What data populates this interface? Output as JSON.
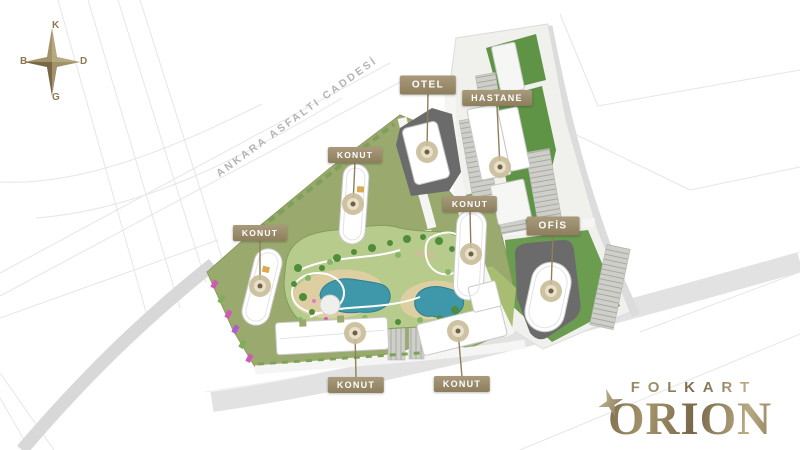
{
  "title": "Folkart Orion site plan",
  "compass": {
    "north": "K",
    "east": "D",
    "south": "G",
    "west": "B"
  },
  "road": {
    "name": "ANKARA ASFALTI CADDESİ"
  },
  "labels": [
    {
      "id": "otel",
      "text": "OTEL"
    },
    {
      "id": "hastane",
      "text": "HASTANE"
    },
    {
      "id": "konut-top",
      "text": "KONUT"
    },
    {
      "id": "konut-center",
      "text": "KONUT"
    },
    {
      "id": "ofis",
      "text": "OFİS"
    },
    {
      "id": "konut-west",
      "text": "KONUT"
    },
    {
      "id": "konut-south",
      "text": "KONUT"
    },
    {
      "id": "konut-southeast",
      "text": "KONUT"
    }
  ],
  "logo": {
    "brand": "FOLKART",
    "project": "ORION"
  },
  "icons": {
    "compass": "compass-rose",
    "logo_star": "four-point-star",
    "pin_marker": "circle-marker"
  },
  "colors": {
    "site_green": "#9aa96e",
    "garden_green": "#b7cb8c",
    "adjacent_green": "#5f9447",
    "pool_blue": "#3f98a9",
    "sand": "#decfa3",
    "dark_plot": "#6b6b6b",
    "label_gold": "#8d7e5d",
    "logo_gold": "#8d7c57",
    "marker_tan": "#c9bb98",
    "road_gray": "#d8d8d8"
  }
}
